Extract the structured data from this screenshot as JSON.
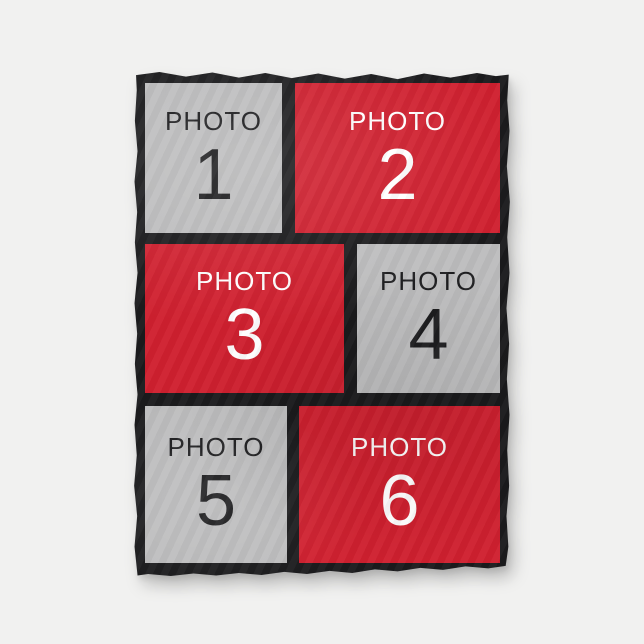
{
  "colors": {
    "page_background": "#f1f1f0",
    "blanket_border": "#1b1b1d",
    "panel_red": "#d0202f",
    "panel_gray": "#bdbdbe",
    "text_on_gray": "#1e1e20",
    "text_on_red": "#ffffff"
  },
  "panels": [
    {
      "label": "PHOTO",
      "number": "1",
      "variant": "gray"
    },
    {
      "label": "PHOTO",
      "number": "2",
      "variant": "red"
    },
    {
      "label": "PHOTO",
      "number": "3",
      "variant": "red"
    },
    {
      "label": "PHOTO",
      "number": "4",
      "variant": "gray"
    },
    {
      "label": "PHOTO",
      "number": "5",
      "variant": "gray"
    },
    {
      "label": "PHOTO",
      "number": "6",
      "variant": "red"
    }
  ]
}
